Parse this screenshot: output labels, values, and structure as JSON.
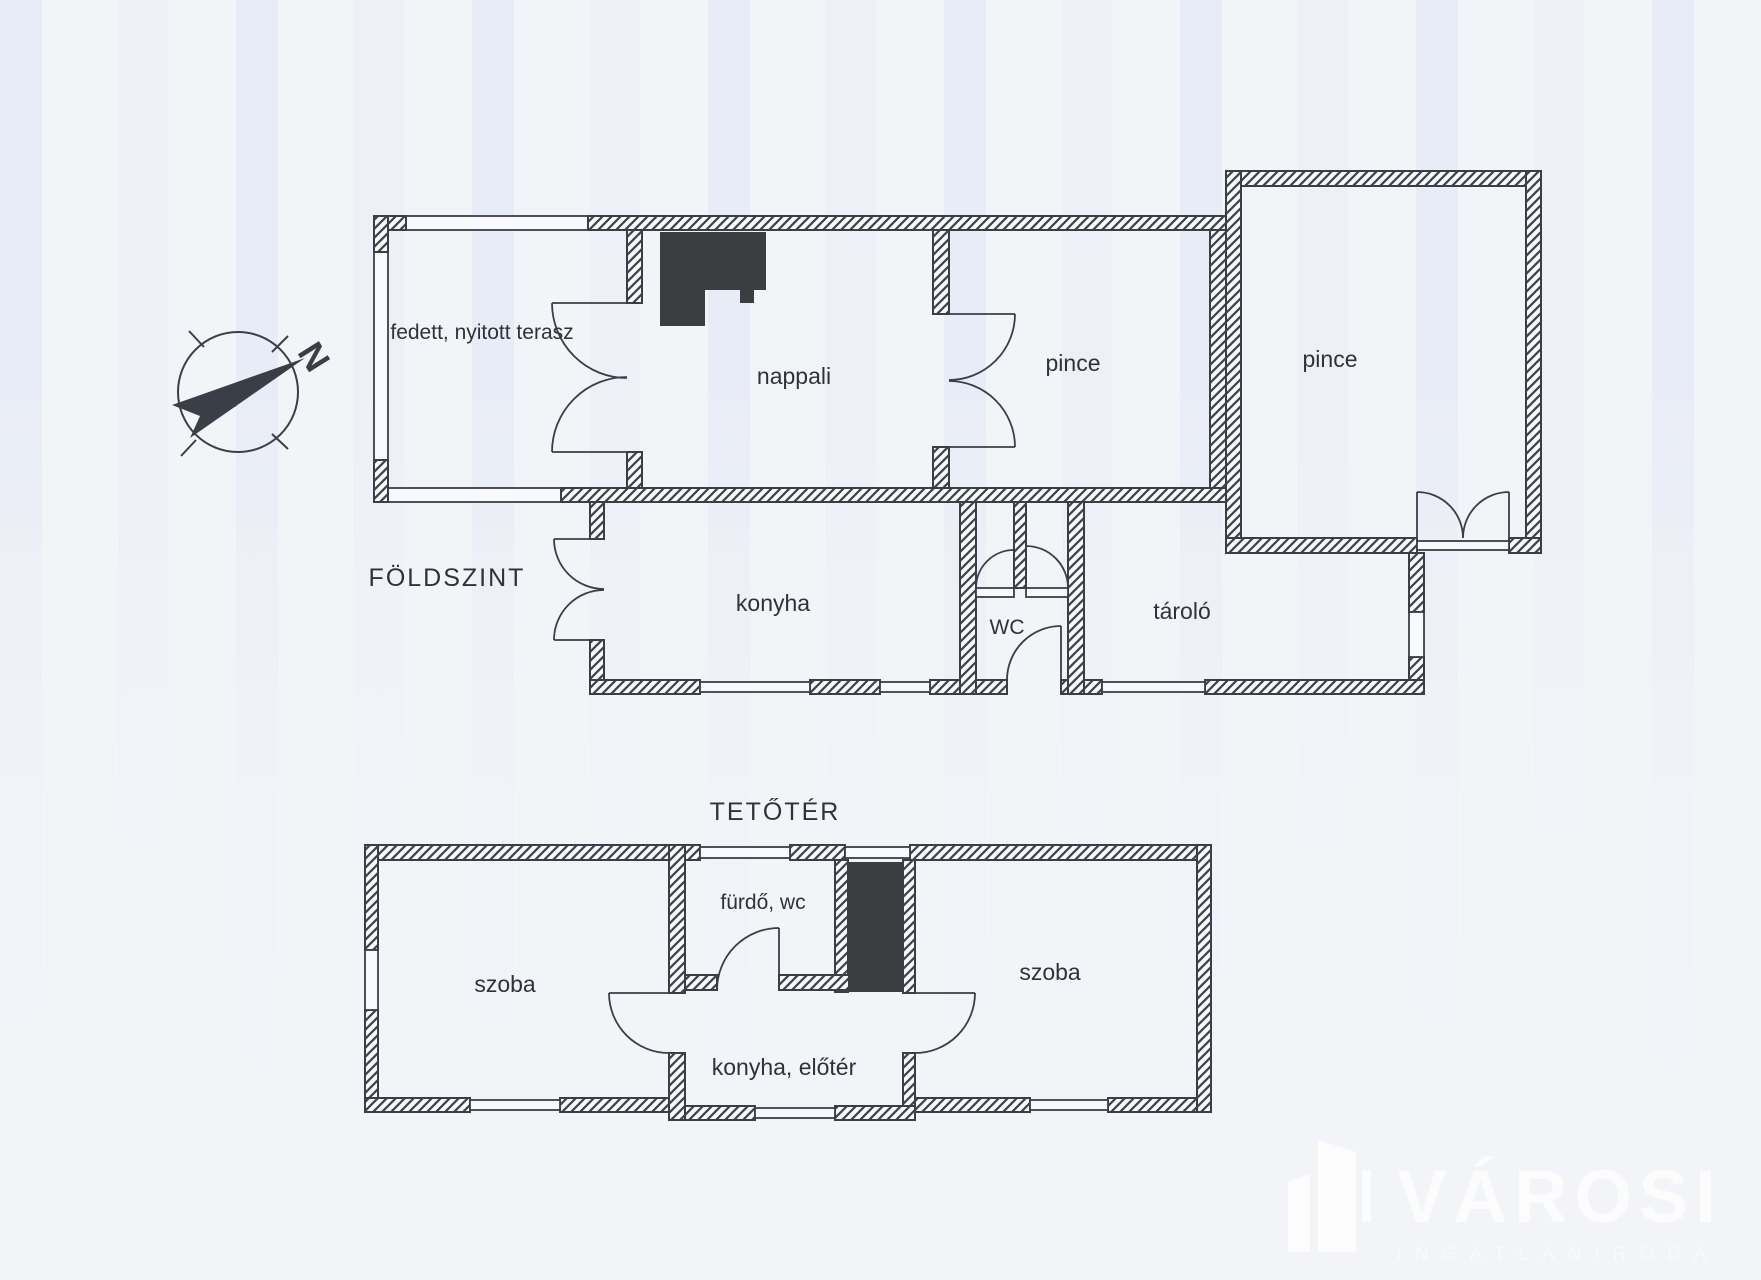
{
  "page": {
    "background": "#f3f4f8",
    "ink_color": "#3a3f47"
  },
  "compass": {
    "north_letter": "N"
  },
  "ground_floor": {
    "title": "FÖLDSZINT",
    "rooms": {
      "terrace": "fedett, nyitott terasz",
      "living_room": "nappali",
      "cellar_left": "pince",
      "cellar_right": "pince",
      "kitchen": "konyha",
      "wc": "WC",
      "storage": "tároló"
    }
  },
  "attic": {
    "title": "TETŐTÉR",
    "rooms": {
      "room_left": "szoba",
      "bathroom": "fürdő, wc",
      "room_right": "szoba",
      "kitchen_hall": "konyha, előtér"
    }
  },
  "watermark": {
    "brand": "VÁROSI",
    "subtitle": "INGATLANIRODA"
  }
}
